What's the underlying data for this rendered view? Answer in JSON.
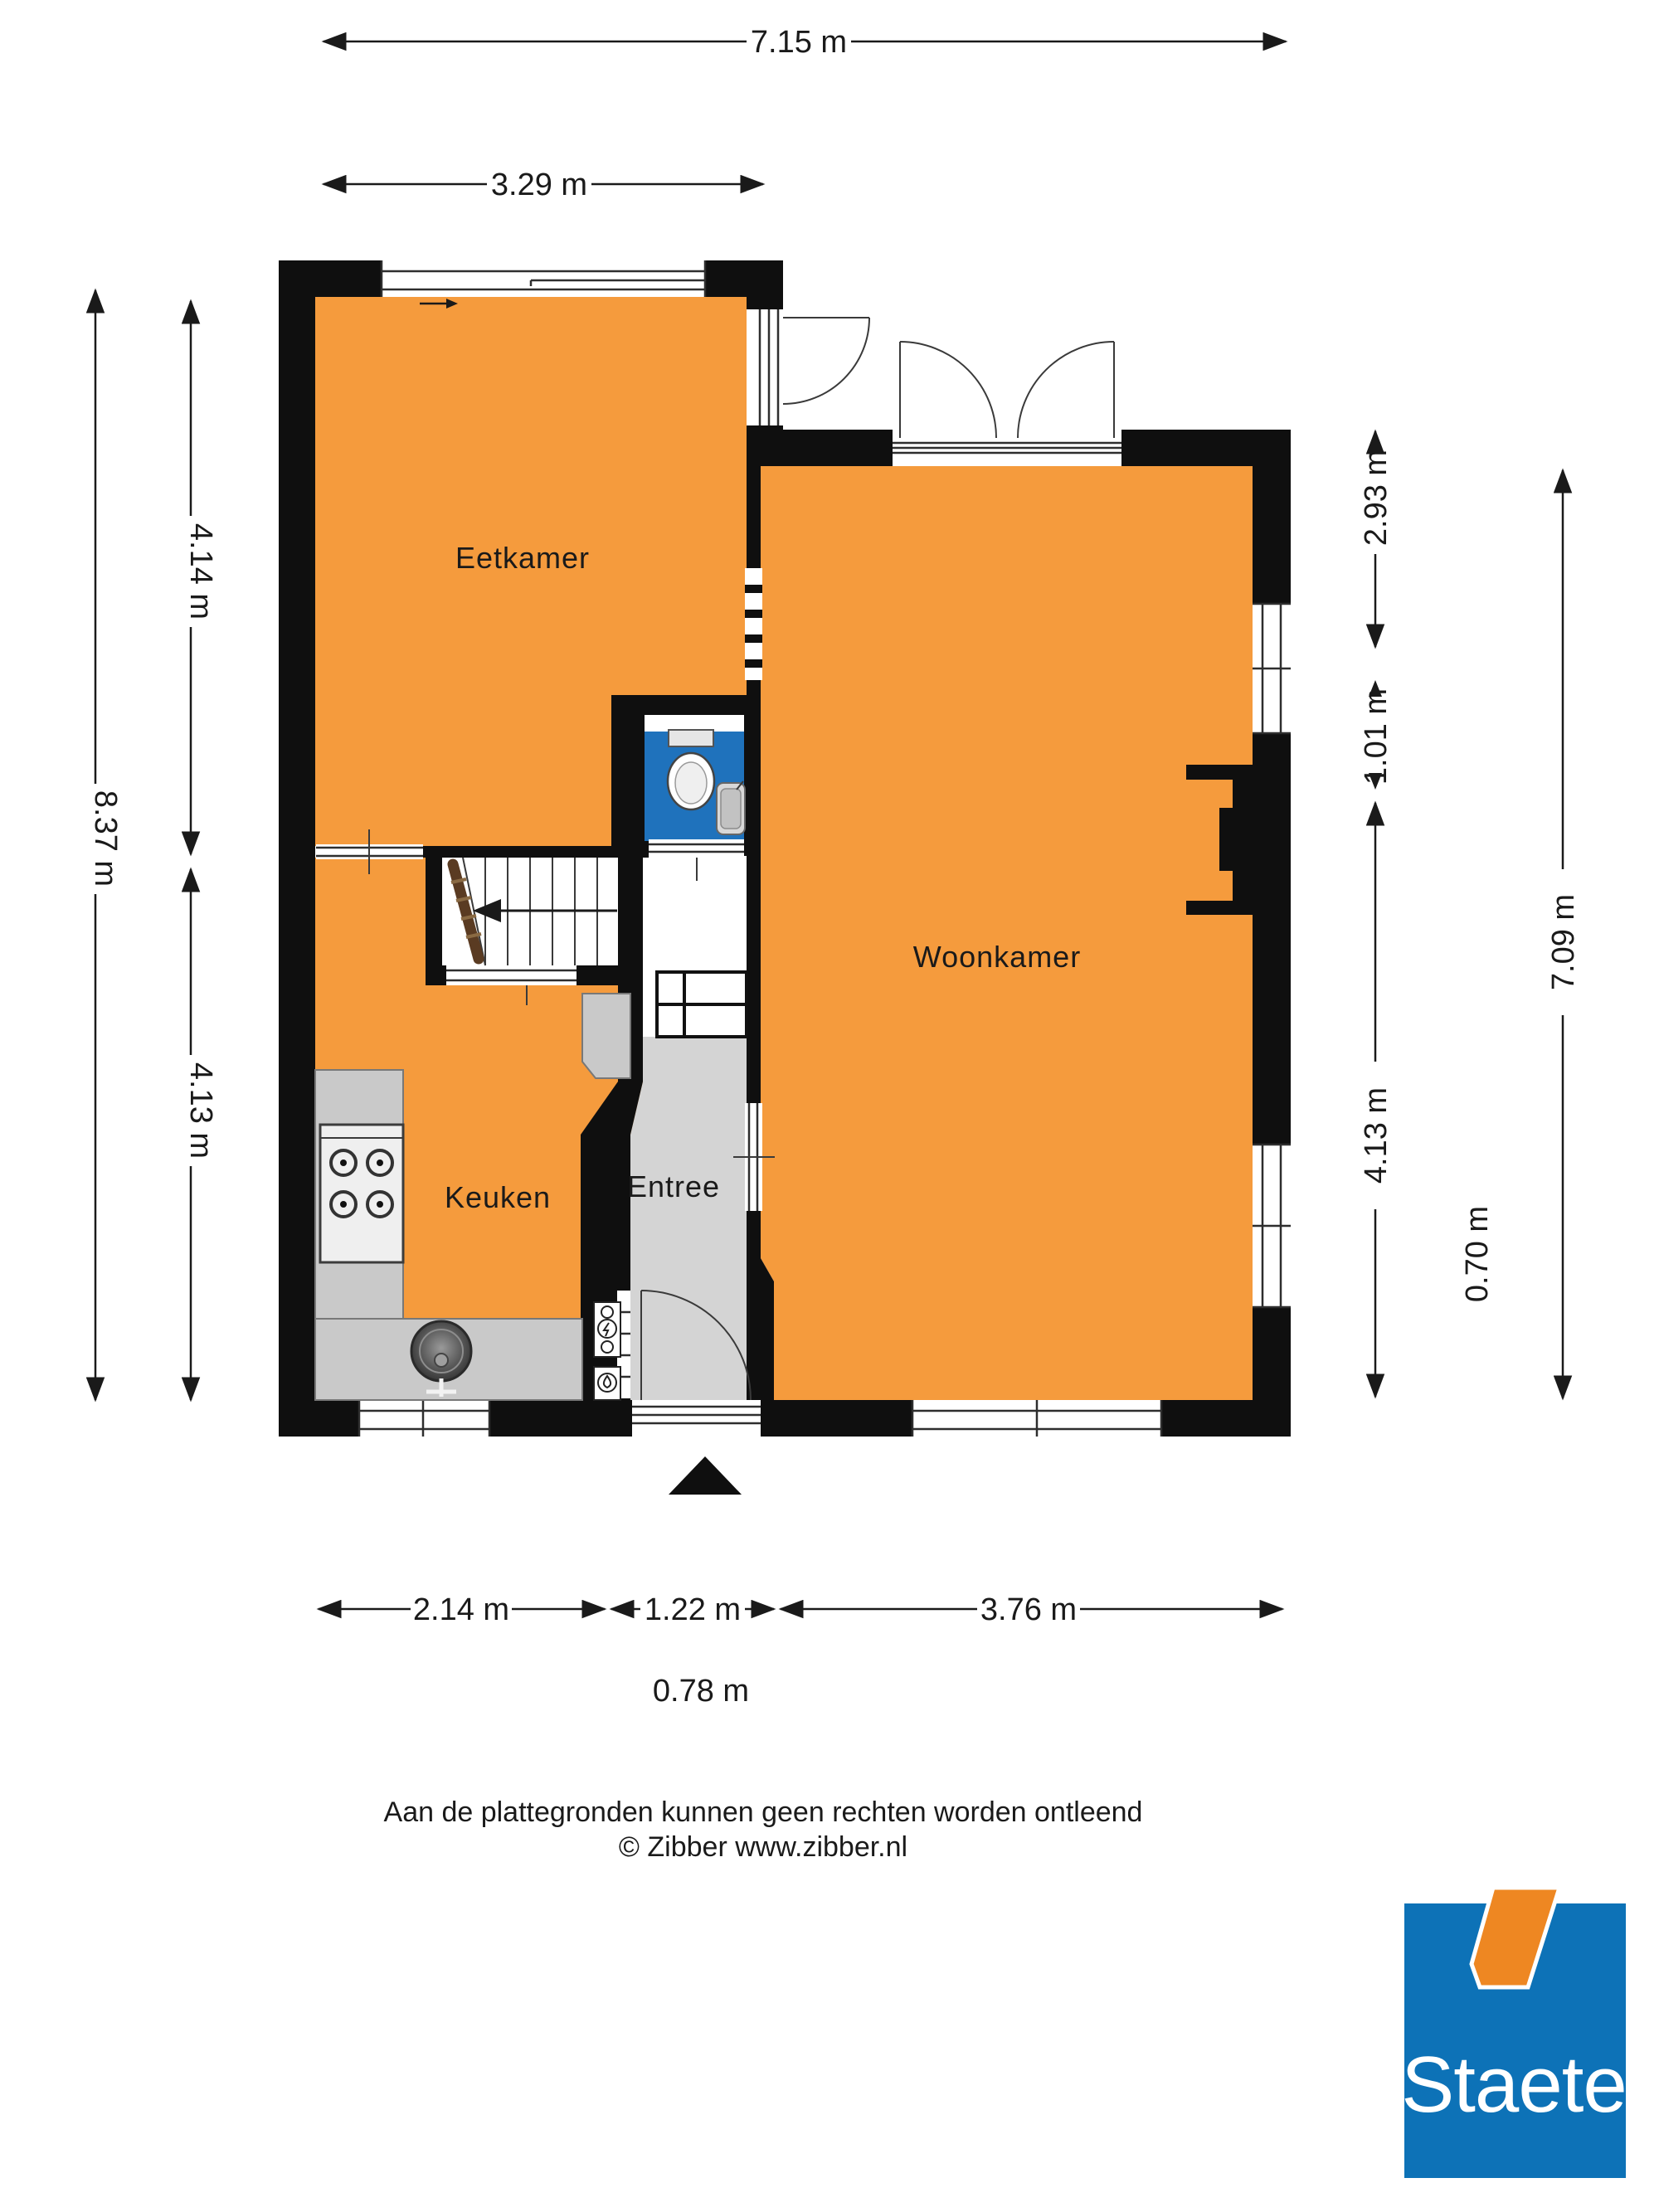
{
  "plan": {
    "rooms": {
      "eetkamer": "Eetkamer",
      "woonkamer": "Woonkamer",
      "keuken": "Keuken",
      "entree": "Entree"
    },
    "dimensions": {
      "top_total": "7.15 m",
      "top_left_section": "3.29 m",
      "left_total": "8.37 m",
      "left_upper": "4.14 m",
      "left_lower": "4.13 m",
      "right_upper": "2.93 m",
      "right_mid": "1.01 m",
      "right_lower": "4.13 m",
      "right_total": "7.09 m",
      "right_extra": "0.70 m",
      "bottom_keuken": "2.14 m",
      "bottom_entree": "1.22 m",
      "bottom_woonkamer": "3.76 m",
      "bottom_door": "0.78 m"
    },
    "colors": {
      "room_fill": "#F59B3D",
      "wall": "#0F0F0F",
      "entree_floor": "#D4D4D4",
      "counter": "#C9C9C9",
      "toilet_floor": "#1F72BC",
      "stair_rail": "#5A3B22"
    }
  },
  "footer": {
    "disclaimer": "Aan de plattegronden kunnen geen rechten worden ontleend",
    "copyright": "© Zibber www.zibber.nl"
  },
  "logo": {
    "text": "Staete",
    "blue": "#0D72B7",
    "orange": "#EE8722"
  }
}
